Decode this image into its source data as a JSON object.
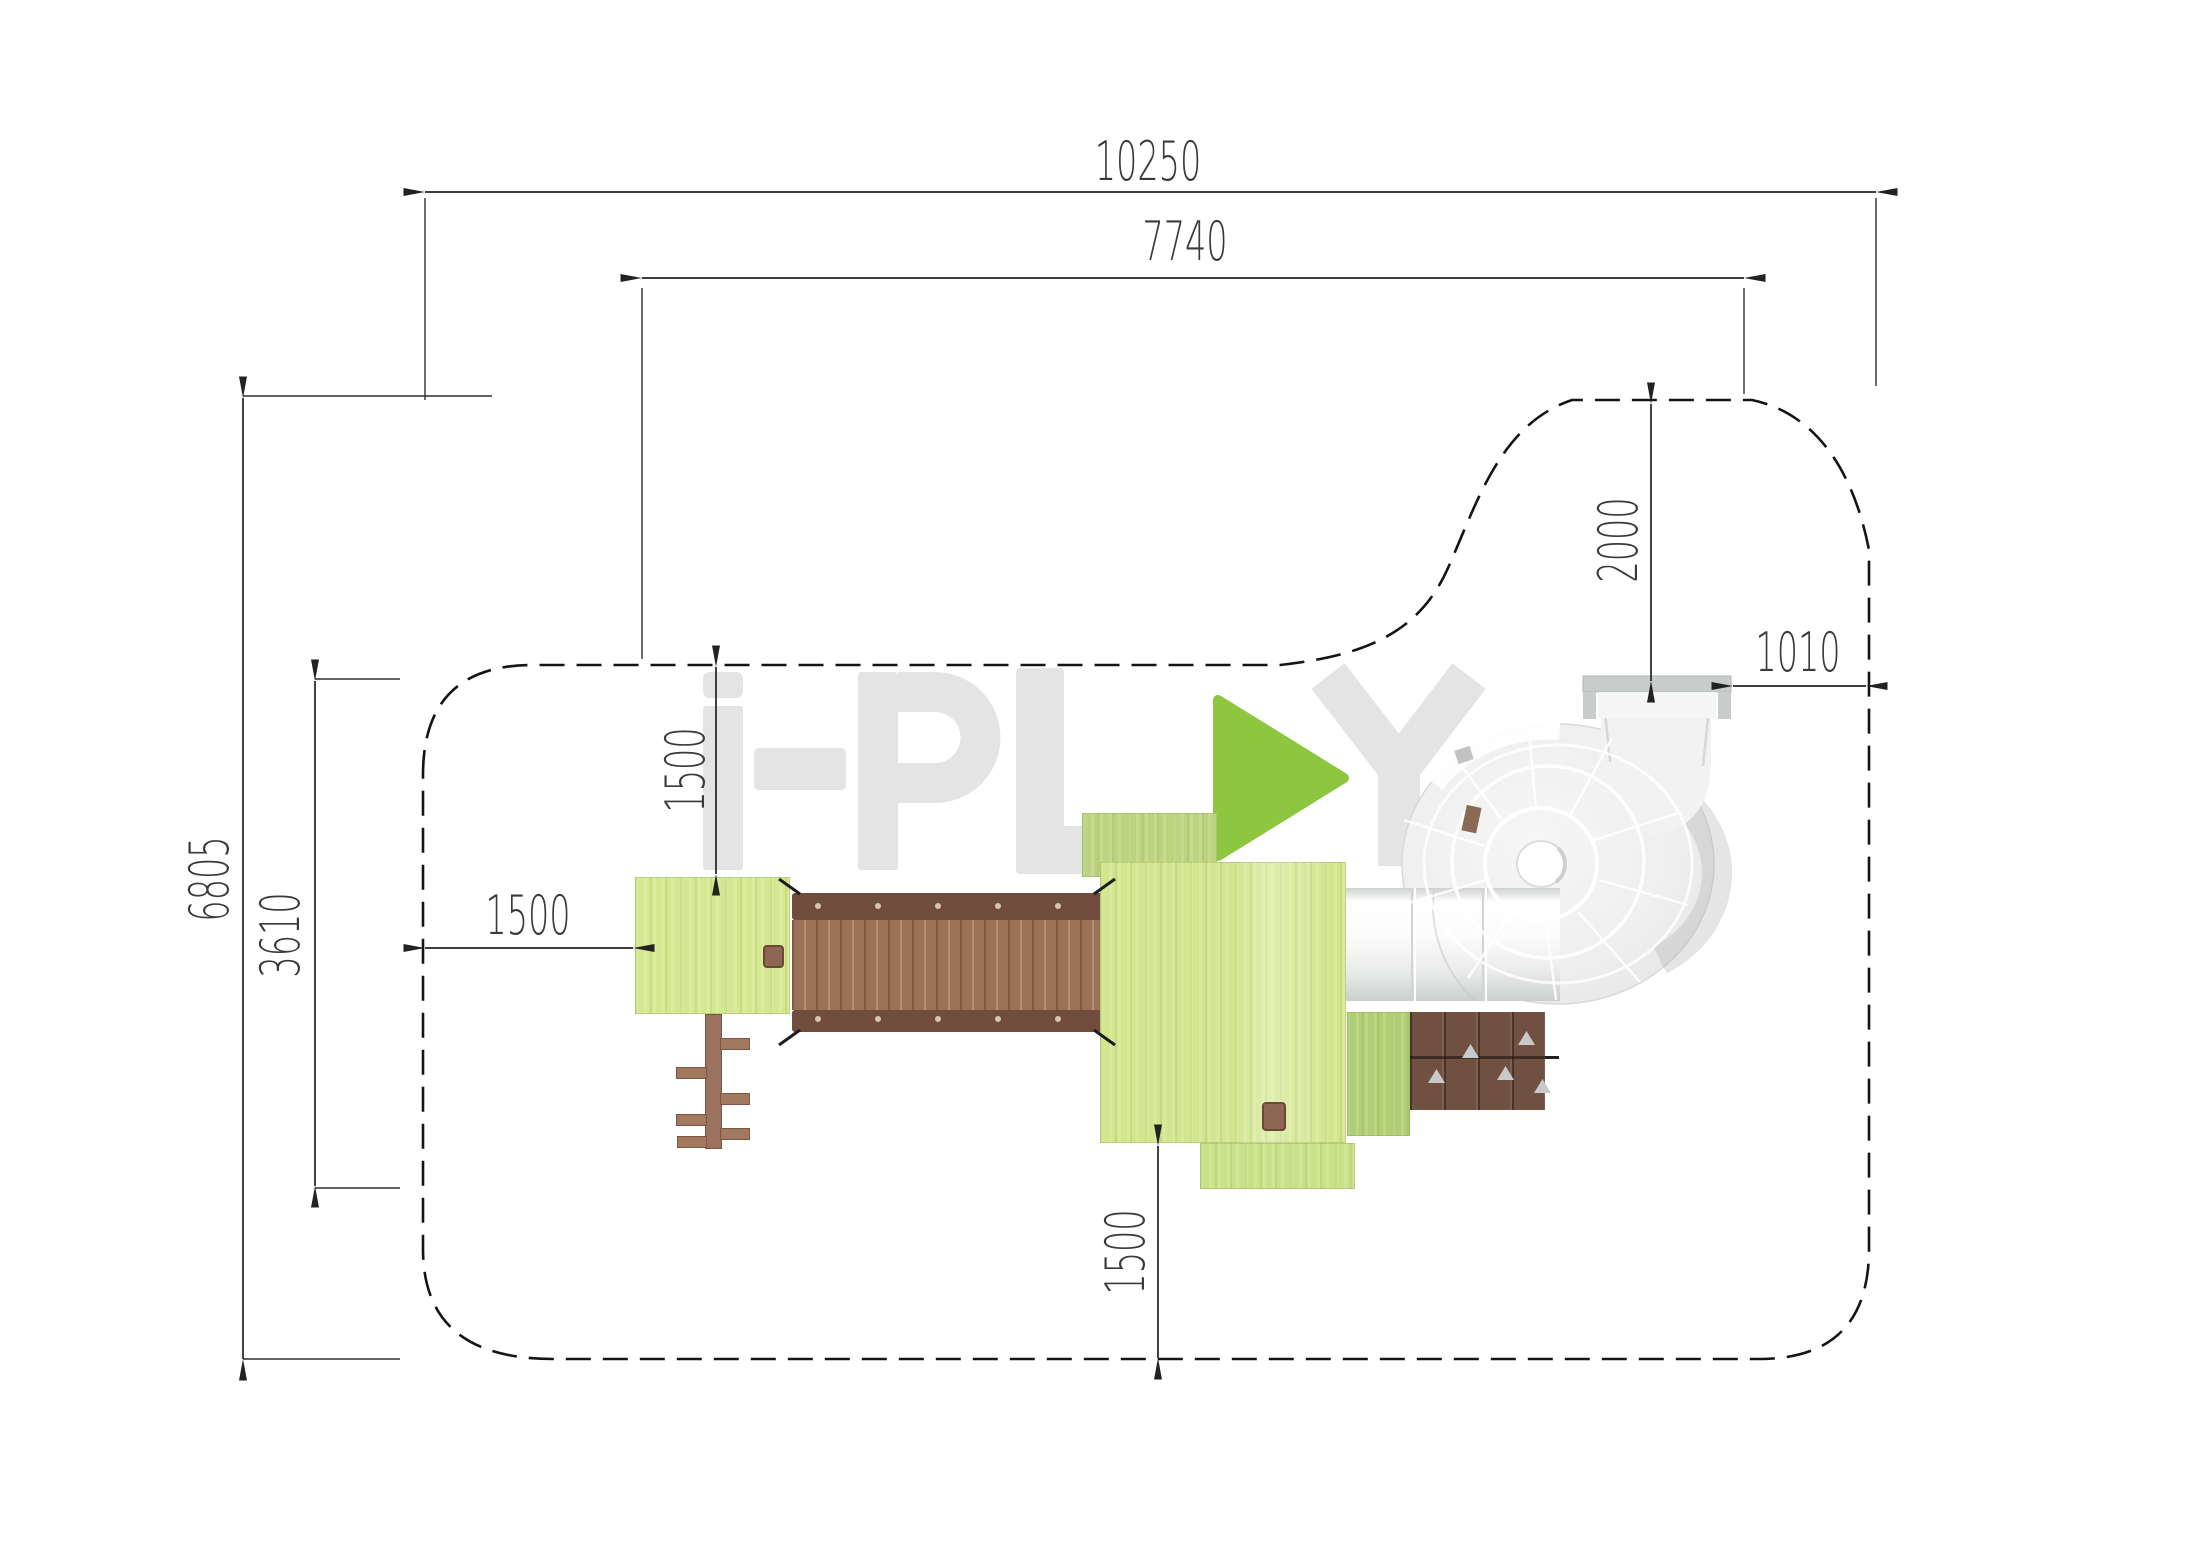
{
  "page": {
    "type": "playground-equipment-plan-view",
    "background": "#ffffff"
  },
  "dimensions": {
    "overall_width": "10250",
    "equipment_width": "7740",
    "overall_depth": "6805",
    "structure_depth": "3610",
    "top_clearance": "2000",
    "right_clearance": "1010",
    "left_clearance": "1500",
    "platform_top_clearance": "1500",
    "bottom_clearance": "1500"
  },
  "watermark": {
    "brand": "i-PLAY",
    "icon": "play-triangle-icon"
  },
  "colors": {
    "platform_green": "#d2e68d",
    "platform_olive": "#bcd480",
    "accent_green": "#8dc63f",
    "bridge_brown": "#9c7257",
    "rail_brown": "#6f4c3b",
    "wall_brown": "#6f5041",
    "slide_gray": "#ececec",
    "dimension_line": "#222222",
    "watermark_gray": "#e4e4e4"
  }
}
